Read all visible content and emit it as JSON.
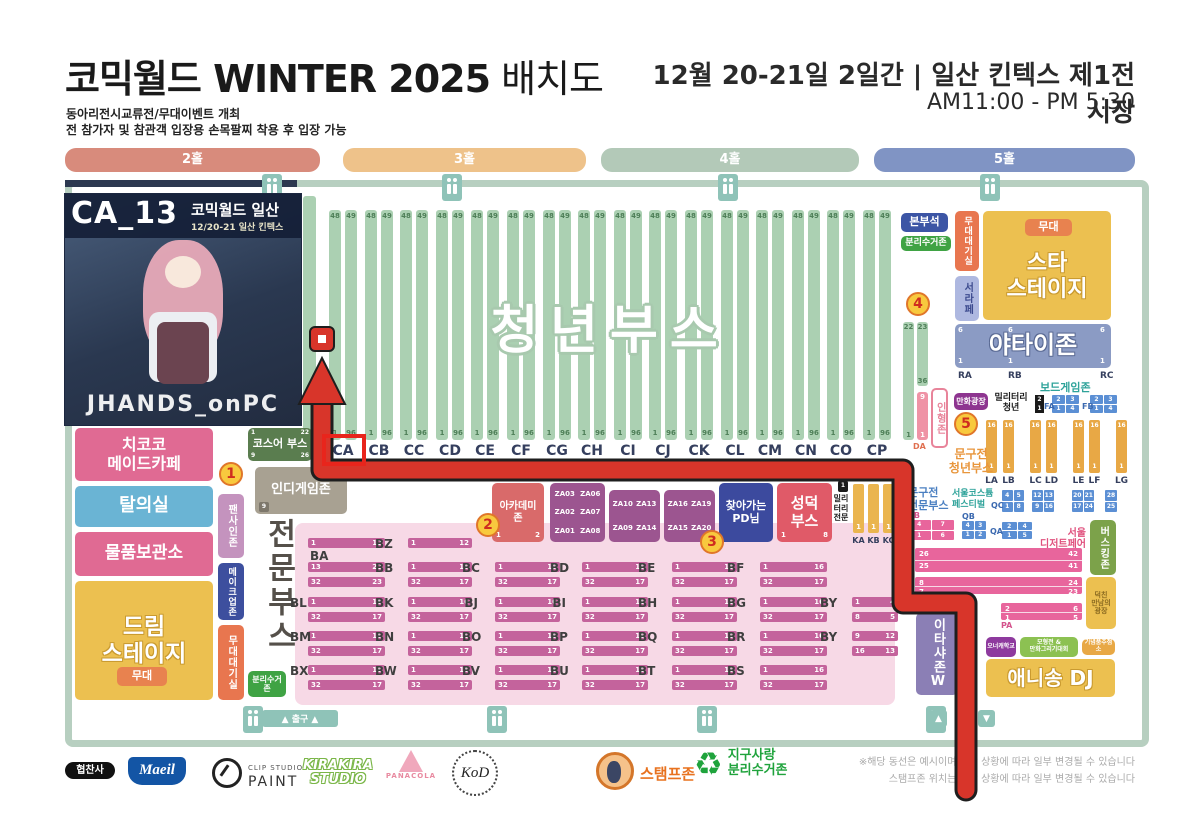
{
  "header": {
    "title_main": "코믹월드 WINTER 2025",
    "title_suffix": " 배치도",
    "sub1": "동아리전시교류전/무대이벤트 개최",
    "sub2": "전 참가자 및 참관객 입장용 손목팔찌 착용 후 입장 가능",
    "date": "12월 20-21일 2일간 | 일산 킨텍스 제1전시장",
    "hours": "AM11:00 - PM 5:30"
  },
  "halls": [
    {
      "label": "2홀",
      "color": "#d88b7c"
    },
    {
      "label": "3홀",
      "color": "#eec28a"
    },
    {
      "label": "4홀",
      "color": "#b3c9b8"
    },
    {
      "label": "5홀",
      "color": "#8094c4"
    }
  ],
  "inset": {
    "booth": "CA_13",
    "event": "코믹월드 일산",
    "date": "12/20-21 일산 킨텍스",
    "artist": "JHANDS_onPC"
  },
  "left": {
    "maid_cafe": [
      "치코코",
      "메이드카페"
    ],
    "dressing": "탈의실",
    "storage": "물품보관소",
    "dream": [
      "드림",
      "스테이지"
    ],
    "stage": "무대"
  },
  "strip": {
    "fan_sign": "팬사인존",
    "makeup": "메이크업존",
    "stage_wait": "무대대기실",
    "recycle": "분리수거존"
  },
  "cos": {
    "label": "코스어 부스",
    "corners": [
      "1",
      "22",
      "9",
      "26"
    ],
    "tag": "NA"
  },
  "indie": {
    "label": "인디게임존",
    "num": "9"
  },
  "pro_title": "전문부스",
  "youth": {
    "watermark": "청년부스",
    "top": [
      "48",
      "49"
    ],
    "bottom": [
      "1",
      "96"
    ],
    "labels": [
      "CA",
      "CB",
      "CC",
      "CD",
      "CE",
      "CF",
      "CG",
      "CH",
      "CI",
      "CJ",
      "CK",
      "CL",
      "CM",
      "CN",
      "CO",
      "CP"
    ],
    "extra_a": {
      "t": "22",
      "b": "1"
    },
    "extra_b": {
      "t": "23",
      "b": "36"
    },
    "doll_col": {
      "t": "9",
      "b": "1",
      "label": "DA"
    }
  },
  "badges": [
    "1",
    "2",
    "3",
    "4",
    "5"
  ],
  "mid": {
    "academy": {
      "label": [
        "아카데미",
        "존"
      ],
      "n": [
        "1",
        "2"
      ]
    },
    "za": [
      [
        [
          "ZA03",
          "ZA06"
        ],
        [
          "ZA02",
          "ZA07"
        ],
        [
          "ZA01",
          "ZA08"
        ]
      ],
      [
        [
          "ZA10",
          "ZA13"
        ],
        [
          "ZA09",
          "ZA14"
        ]
      ],
      [
        [
          "ZA16",
          "ZA19"
        ],
        [
          "ZA15",
          "ZA20"
        ]
      ]
    ],
    "pd": [
      "찾아가는",
      "PD님"
    ],
    "seongdeok": {
      "label": [
        "성덕",
        "부스"
      ],
      "n": [
        "1",
        "8"
      ]
    },
    "military": {
      "chip": "1",
      "lines": [
        "밀리",
        "터리",
        "전문"
      ]
    },
    "kcols": {
      "labels": [
        "KA",
        "KB",
        "KC"
      ],
      "b": "1"
    }
  },
  "right": {
    "hq": "본부석",
    "recycle": "분리수거존",
    "stage_wait": "무대대기실",
    "seorape": "서라페",
    "star": [
      "스타",
      "스테이지"
    ],
    "stage_badge": "무대",
    "yatai": {
      "label": "야타이존",
      "t": "6",
      "b": "1",
      "cols": [
        "RA",
        "RB",
        "RC"
      ]
    },
    "board": {
      "label": "보드게임존",
      "groups": [
        "FA",
        "FB"
      ],
      "t": [
        "2",
        "3"
      ],
      "b": [
        "1",
        "4"
      ]
    },
    "mil_youth": {
      "label": [
        "밀리터리",
        "청년"
      ],
      "chip": [
        "2",
        "1"
      ]
    },
    "plaza": "만화광장",
    "doll": "인형존",
    "mungu_youth": [
      "문구전",
      "청년부스"
    ],
    "lcols": {
      "labels": [
        "LA",
        "LB",
        "LC",
        "LD",
        "LE",
        "LF",
        "LG"
      ],
      "t": "16",
      "b": "1"
    },
    "mungu_pro": [
      "문구전",
      "전문부스"
    ],
    "costume": [
      "서울코스튬",
      "페스티벌"
    ],
    "qc": "QC",
    "q_groups": [
      {
        "t": [
          "4",
          "5"
        ],
        "b": [
          "1",
          "8"
        ]
      },
      {
        "t": [
          "12",
          "13"
        ],
        "b": [
          "9",
          "16"
        ]
      },
      {
        "t": [
          "20",
          "21"
        ],
        "b": [
          "17",
          "24"
        ]
      },
      {
        "t": [
          "28"
        ],
        "b": [
          "25"
        ]
      }
    ],
    "qb": {
      "label": "QB",
      "t": [
        "4",
        "3"
      ],
      "b": [
        "1",
        "2"
      ]
    },
    "qa": {
      "label": "QA",
      "t": [
        "2",
        "4"
      ],
      "b": [
        "1",
        "5"
      ]
    },
    "pb": {
      "label": "PB",
      "t": [
        "4",
        "7"
      ],
      "b": [
        "1",
        "6"
      ]
    },
    "dessert": [
      "서울",
      "디저트페어"
    ],
    "busking": "버스킹존",
    "pa": {
      "label": "PA",
      "bars": [
        {
          "t": [
            "26",
            "42"
          ],
          "b": [
            "25",
            "41"
          ]
        },
        {
          "t": [
            "8",
            "24"
          ],
          "b": [
            "7",
            "23"
          ]
        },
        {
          "t": [
            "2",
            "6"
          ],
          "b": [
            "1",
            "5"
          ]
        }
      ]
    },
    "meet": [
      "덕친",
      "만남의",
      "광장"
    ],
    "itasha": "이타샤존W",
    "owner": "오너캐학교",
    "model": [
      "모형전 &",
      "만화그리기대회"
    ],
    "raffle": "기념품추첨소",
    "anisong": "애니송 DJ"
  },
  "pro_rows": [
    [
      {
        "l": "BA",
        "slot": 0,
        "t": [
          "1",
          "12"
        ],
        "below": true
      },
      {
        "l": "BZ",
        "slot": 1,
        "t": [
          "1",
          "12"
        ]
      }
    ],
    [
      {
        "l": "",
        "slot": 0,
        "t": [
          "13",
          "22"
        ],
        "b": [
          "32",
          "23"
        ]
      },
      {
        "l": "BB",
        "slot": 1
      },
      {
        "l": "BC",
        "slot": 2
      },
      {
        "l": "BD",
        "slot": 3
      },
      {
        "l": "BE",
        "slot": 4
      },
      {
        "l": "BF",
        "slot": 5
      }
    ],
    [
      {
        "l": "BL",
        "slot": 0
      },
      {
        "l": "BK",
        "slot": 1
      },
      {
        "l": "BJ",
        "slot": 2
      },
      {
        "l": "BI",
        "slot": 3
      },
      {
        "l": "BH",
        "slot": 4
      },
      {
        "l": "BG",
        "slot": 5
      },
      {
        "l": "BY",
        "slot": 6,
        "t": [
          "1",
          "4"
        ],
        "b": [
          "8",
          "5"
        ]
      }
    ],
    [
      {
        "l": "BM",
        "slot": 0
      },
      {
        "l": "BN",
        "slot": 1
      },
      {
        "l": "BO",
        "slot": 2
      },
      {
        "l": "BP",
        "slot": 3
      },
      {
        "l": "BQ",
        "slot": 4
      },
      {
        "l": "BR",
        "slot": 5
      },
      {
        "l": "BY",
        "slot": 6,
        "t": [
          "9",
          "12"
        ],
        "b": [
          "16",
          "13"
        ]
      }
    ],
    [
      {
        "l": "BX",
        "slot": 0
      },
      {
        "l": "BW",
        "slot": 1
      },
      {
        "l": "BV",
        "slot": 2
      },
      {
        "l": "BU",
        "slot": 3
      },
      {
        "l": "BT",
        "slot": 4
      },
      {
        "l": "BS",
        "slot": 5
      }
    ]
  ],
  "pro_defaults": {
    "t": [
      "1",
      "16"
    ],
    "b": [
      "32",
      "17"
    ]
  },
  "exits": {
    "left": "▲ 출구 ▲",
    "up": "▲",
    "down": "▼"
  },
  "footer": {
    "sponsor": "협찬사",
    "maeil": "Maeil",
    "clip1": "CLIP STUDIO",
    "clip2": "PAINT",
    "kira": [
      "KIRAKIRA",
      "STUDIO"
    ],
    "pana": "PANACOLA",
    "kod": "KoD",
    "stamp": "스탬프존",
    "earth": [
      "지구사랑",
      "분리수거존"
    ],
    "notice1": "※해당 동선은 예시이며 현장 상황에 따라 일부 변경될 수 있습니다",
    "notice2": "스탬프존 위치는 현장 상황에 따라 일부 변경될 수 있습니다"
  },
  "colors": {
    "route": "#d8352a",
    "highlight": "#e8251c"
  }
}
